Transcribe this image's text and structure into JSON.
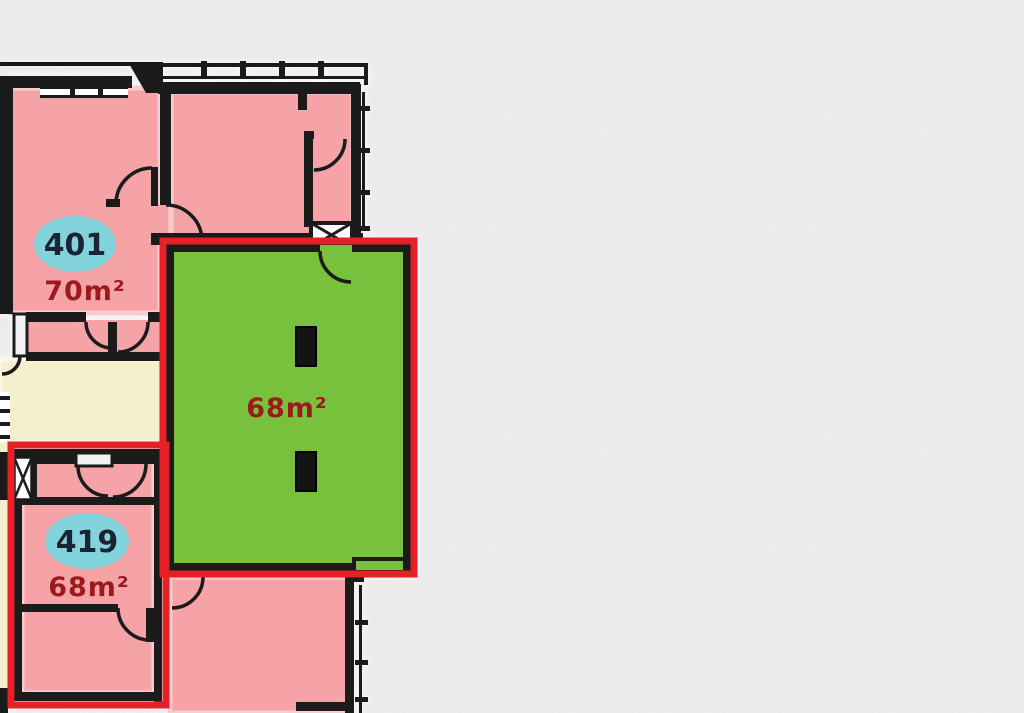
{
  "view": {
    "type": "floorplan-viewer",
    "background_color": "#ececec"
  },
  "colors": {
    "room_pink": "#f5a3a7",
    "room_pink_edge": "#f9cbcf",
    "selected_green": "#77c13d",
    "selection_outline_red": "#e32127",
    "corridor_cream": "#f4efcd",
    "badge_cyan": "#82d3dc",
    "badge_text": "#1c2333",
    "area_text": "#9c1a1f",
    "wall_black": "#1b1b1b"
  },
  "plan": {
    "units": [
      {
        "id": "401",
        "number": "401",
        "area": "70m²",
        "state": "available"
      },
      {
        "id": "419",
        "number": "419",
        "area": "68m²",
        "state": "outlined"
      },
      {
        "id": "selected",
        "number": "",
        "area": "68m²",
        "state": "selected"
      }
    ]
  }
}
